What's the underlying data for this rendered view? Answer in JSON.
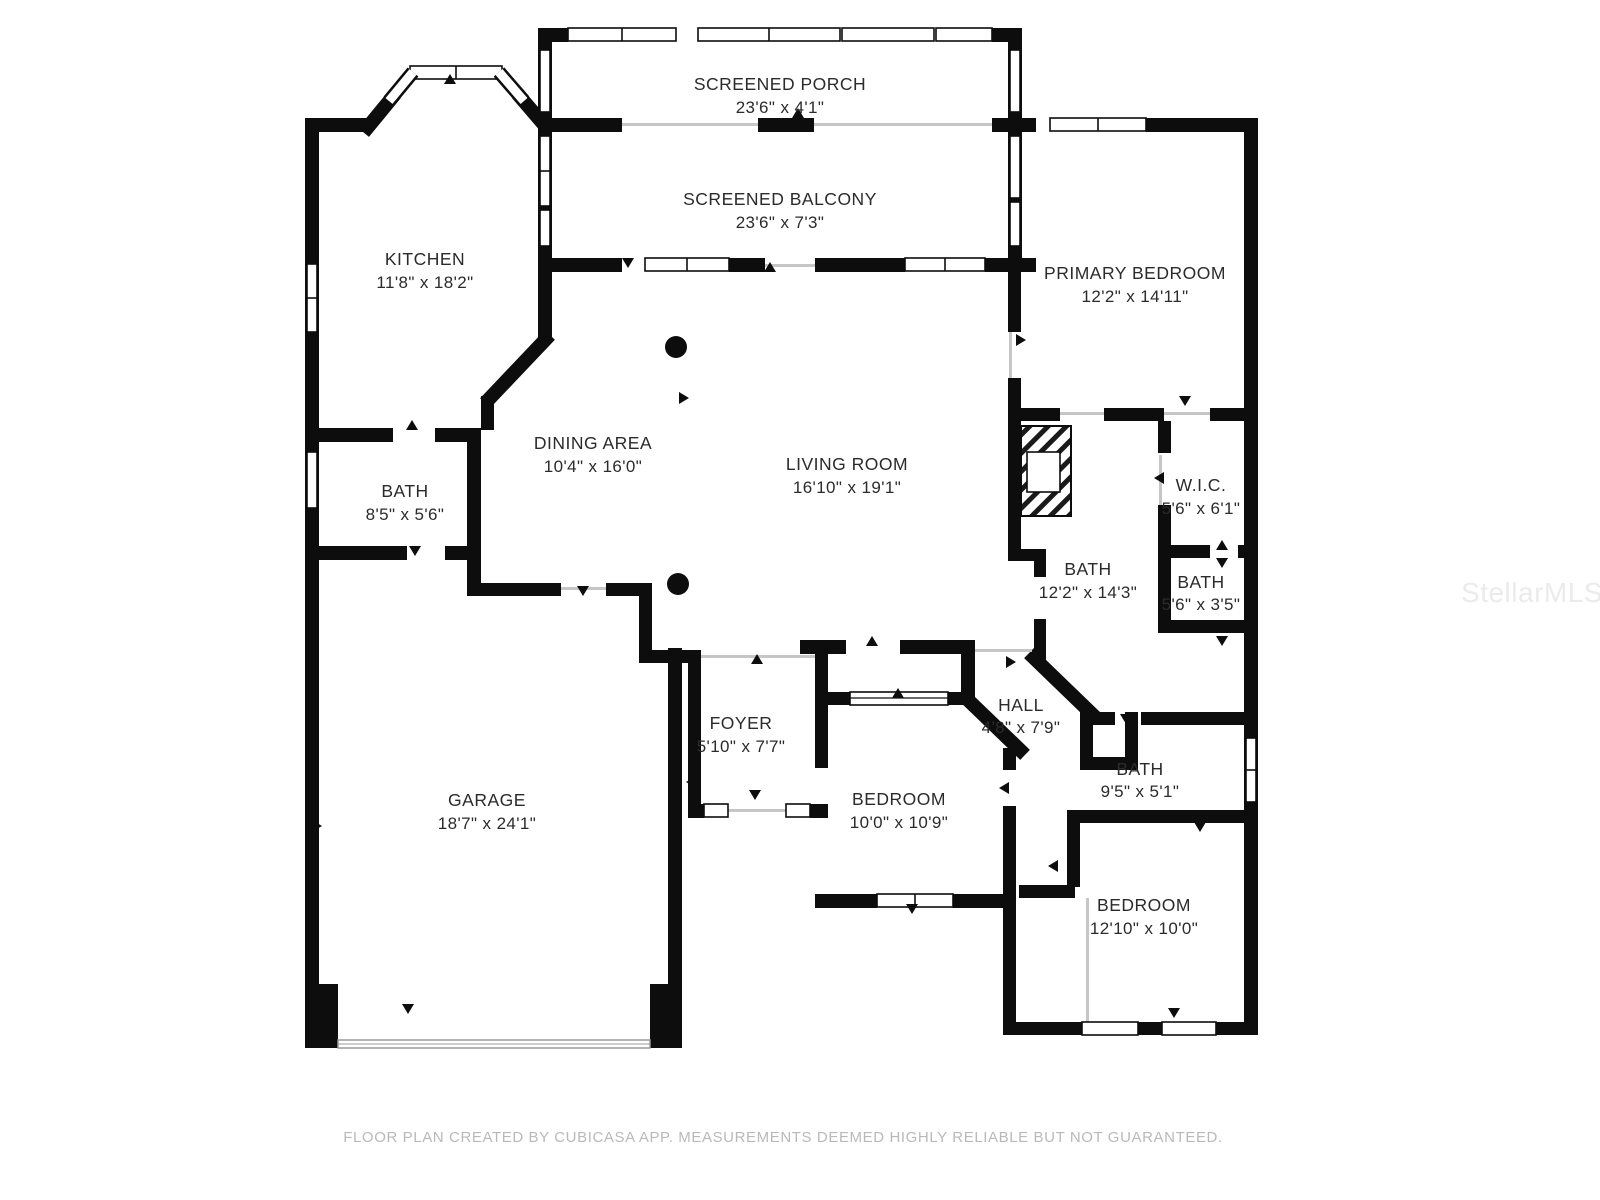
{
  "rooms": [
    {
      "name": "SCREENED PORCH",
      "dims": "23'6\" x 4'1\""
    },
    {
      "name": "SCREENED BALCONY",
      "dims": "23'6\" x 7'3\""
    },
    {
      "name": "KITCHEN",
      "dims": "11'8\" x 18'2\""
    },
    {
      "name": "PRIMARY BEDROOM",
      "dims": "12'2\" x 14'11\""
    },
    {
      "name": "DINING AREA",
      "dims": "10'4\" x 16'0\""
    },
    {
      "name": "LIVING ROOM",
      "dims": "16'10\" x 19'1\""
    },
    {
      "name": "BATH",
      "dims": "8'5\" x 5'6\""
    },
    {
      "name": "W.I.C.",
      "dims": "5'6\" x 6'1\""
    },
    {
      "name": "BATH",
      "dims": "12'2\" x 14'3\""
    },
    {
      "name": "BATH",
      "dims": "5'6\" x 3'5\""
    },
    {
      "name": "FOYER",
      "dims": "5'10\" x 7'7\""
    },
    {
      "name": "HALL",
      "dims": "4'8\" x 7'9\""
    },
    {
      "name": "GARAGE",
      "dims": "18'7\" x 24'1\""
    },
    {
      "name": "BEDROOM",
      "dims": "10'0\" x 10'9\""
    },
    {
      "name": "BATH",
      "dims": "9'5\" x 5'1\""
    },
    {
      "name": "BEDROOM",
      "dims": "12'10\" x 10'0\""
    }
  ],
  "footer": {
    "text": "FLOOR PLAN CREATED BY CUBICASA APP. MEASUREMENTS DEEMED HIGHLY RELIABLE BUT NOT GUARANTEED."
  },
  "watermark": {
    "text": "StellarMLS"
  },
  "colors": {
    "wall": "#0d0d0d",
    "open_line": "#c6c6c6",
    "label": "#2b2b2b",
    "footer": "#b9b9b9"
  }
}
